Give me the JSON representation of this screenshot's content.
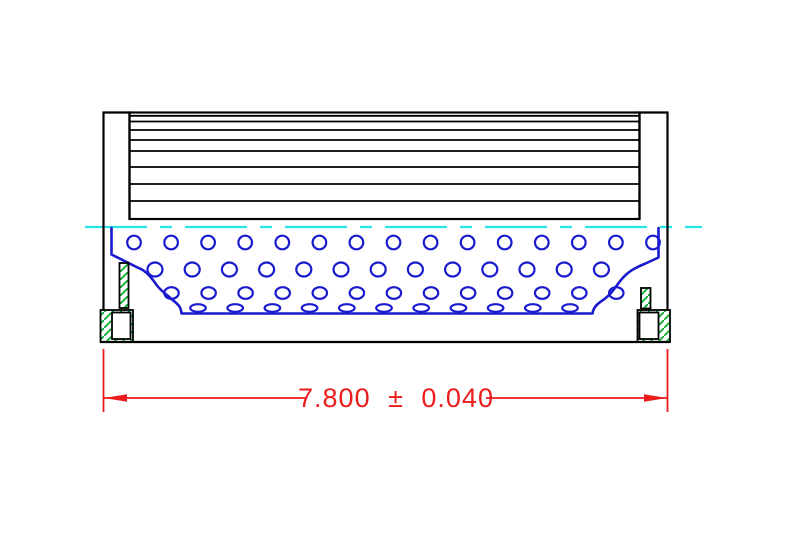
{
  "drawing": {
    "kind": "filter-element-cross-section",
    "dimension": {
      "label": "7.800 ± 0.040",
      "value": "7.800",
      "plus_minus": "±",
      "tolerance": "0.040"
    },
    "colors": {
      "background": "#ffffff",
      "outline": "#000000",
      "core": "#1a1ace",
      "centerline": "#2ae4ec",
      "gasket_hatch": "#00ad2b",
      "dimension": "#ed1c1c"
    },
    "media": {
      "x1": 130,
      "x2": 639,
      "pleat_lines_y": [
        115.8,
        121.5,
        130,
        140,
        151,
        167,
        184,
        201
      ]
    },
    "core_holes": {
      "rows": [
        {
          "cy": 242.5,
          "rx": 6.8,
          "ry": 6.8,
          "x_start": 134.0,
          "step": 37.07,
          "count": 15
        },
        {
          "cy": 269.5,
          "rx": 7.5,
          "ry": 7.0,
          "x_start": 155.0,
          "step": 37.2,
          "count": 13
        },
        {
          "cy": 293.0,
          "rx": 7.2,
          "ry": 5.8,
          "x_start": 171.5,
          "step": 37.07,
          "count": 13
        },
        {
          "cy": 308.0,
          "rx": 7.8,
          "ry": 3.8,
          "x_start": 198.0,
          "step": 37.2,
          "count": 11
        }
      ]
    }
  }
}
